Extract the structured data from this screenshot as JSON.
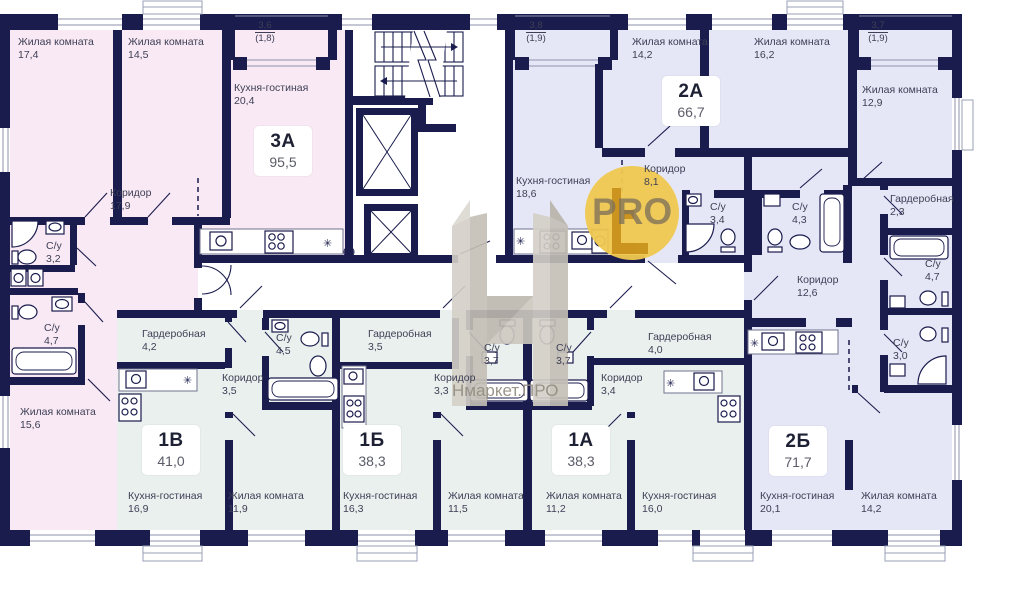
{
  "plan": {
    "colors": {
      "wall": "#1a1c4d",
      "apartment_3a_fill": "#f8e9f4",
      "apartment_2a_fill": "#e5e7f6",
      "apartment_2b_fill": "#e5e7f6",
      "apartment_1v_fill": "#eaf0ee",
      "apartment_1b_fill": "#eaf0ee",
      "apartment_1a_fill": "#eaf0ee",
      "watermark_circle": "#f0c850",
      "watermark_grey": "#cdc8bf"
    },
    "apartments": [
      {
        "label": "3А",
        "area": "95,5"
      },
      {
        "label": "2А",
        "area": "66,7"
      },
      {
        "label": "1В",
        "area": "41,0"
      },
      {
        "label": "1Б",
        "area": "38,3"
      },
      {
        "label": "1А",
        "area": "38,3"
      },
      {
        "label": "2Б",
        "area": "71,7"
      }
    ],
    "rooms": [
      {
        "name": "Жилая комната",
        "area": "17,4"
      },
      {
        "name": "Жилая комната",
        "area": "14,5"
      },
      {
        "name": "Кухня-гостиная",
        "area": "20,4"
      },
      {
        "name": "Коридор",
        "area": "17,9"
      },
      {
        "name": "С/у",
        "area": "3,2"
      },
      {
        "name": "С/у",
        "area": "4,7"
      },
      {
        "name": "Жилая комната",
        "area": "15,6"
      },
      {
        "name": "Кухня-гостиная",
        "area": "18,6"
      },
      {
        "name": "Жилая комната",
        "area": "14,2"
      },
      {
        "name": "Жилая комната",
        "area": "16,2"
      },
      {
        "name": "Коридор",
        "area": "8,1"
      },
      {
        "name": "С/у",
        "area": "3,4"
      },
      {
        "name": "С/у",
        "area": "4,3"
      },
      {
        "name": "Жилая комната",
        "area": "12,9"
      },
      {
        "name": "Гардеробная",
        "area": "2,3"
      },
      {
        "name": "С/у",
        "area": "4,7"
      },
      {
        "name": "Коридор",
        "area": "12,6"
      },
      {
        "name": "С/у",
        "area": "3,0"
      },
      {
        "name": "Кухня-гостиная",
        "area": "20,1"
      },
      {
        "name": "Жилая комната",
        "area": "14,2"
      },
      {
        "name": "Гардеробная",
        "area": "4,2"
      },
      {
        "name": "С/у",
        "area": "4,5"
      },
      {
        "name": "Коридор",
        "area": "3,5"
      },
      {
        "name": "Кухня-гостиная",
        "area": "16,9"
      },
      {
        "name": "Жилая комната",
        "area": "11,9"
      },
      {
        "name": "Гардеробная",
        "area": "3,5"
      },
      {
        "name": "Коридор",
        "area": "3,3"
      },
      {
        "name": "С/у",
        "area": "3,7"
      },
      {
        "name": "Кухня-гостиная",
        "area": "16,3"
      },
      {
        "name": "Жилая комната",
        "area": "11,5"
      },
      {
        "name": "С/у",
        "area": "3,7"
      },
      {
        "name": "Коридор",
        "area": "3,4"
      },
      {
        "name": "Гардеробная",
        "area": "4,0"
      },
      {
        "name": "Жилая комната",
        "area": "11,2"
      },
      {
        "name": "Кухня-гостиная",
        "area": "16,0"
      }
    ],
    "balconies": [
      {
        "area": "3,6",
        "area_reduced": "(1,8)"
      },
      {
        "area": "3,8",
        "area_reduced": "(1,9)"
      },
      {
        "area": "3,7",
        "area_reduced": "(1,9)"
      }
    ],
    "watermark": {
      "badge": "PRO",
      "brand": "Нмаркет.ПРО"
    }
  }
}
